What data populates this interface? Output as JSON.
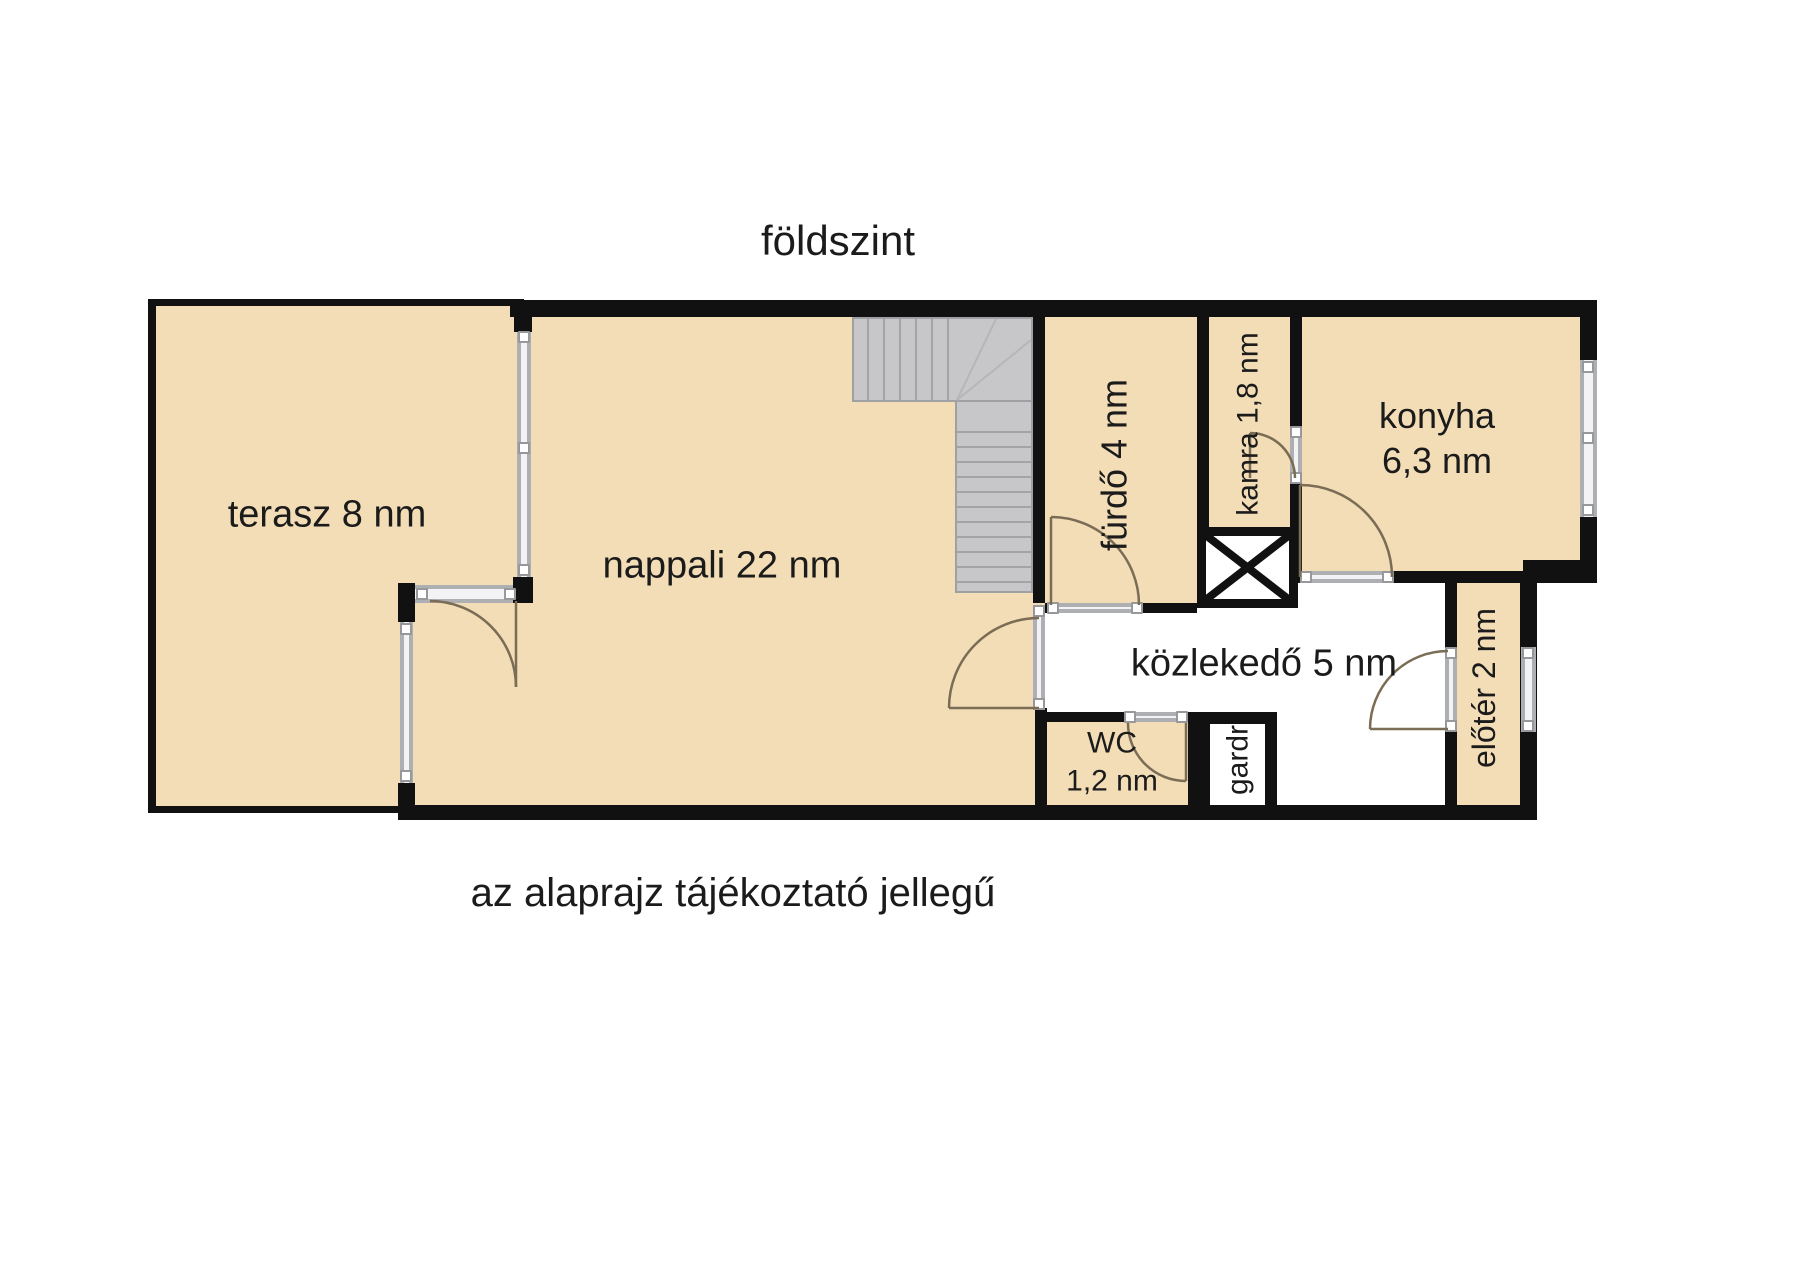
{
  "title": "földszint",
  "disclaimer": "az alaprajz tájékoztató jellegű",
  "rooms": {
    "terasz": {
      "label": "terasz 8 nm"
    },
    "nappali": {
      "label": "nappali 22 nm"
    },
    "furdo": {
      "label": "fürdő 4 nm"
    },
    "kamra": {
      "label": "kamra 1,8 nm"
    },
    "konyha": {
      "name": "konyha",
      "area": "6,3 nm"
    },
    "kozlekedo": {
      "label": "közlekedő 5 nm"
    },
    "wc": {
      "name": "WC",
      "area": "1,2 nm"
    },
    "gardrob": {
      "label": "gardr"
    },
    "eloter": {
      "label": "előtér 2 nm"
    }
  },
  "colors": {
    "floor_fill": "#f2ddb6",
    "wall": "#111111",
    "stairs": "#c7c7c9",
    "window_frame": "#aeafb3",
    "door_swing": "#7a6c55",
    "text": "#1b1b1b",
    "background": "#ffffff"
  }
}
